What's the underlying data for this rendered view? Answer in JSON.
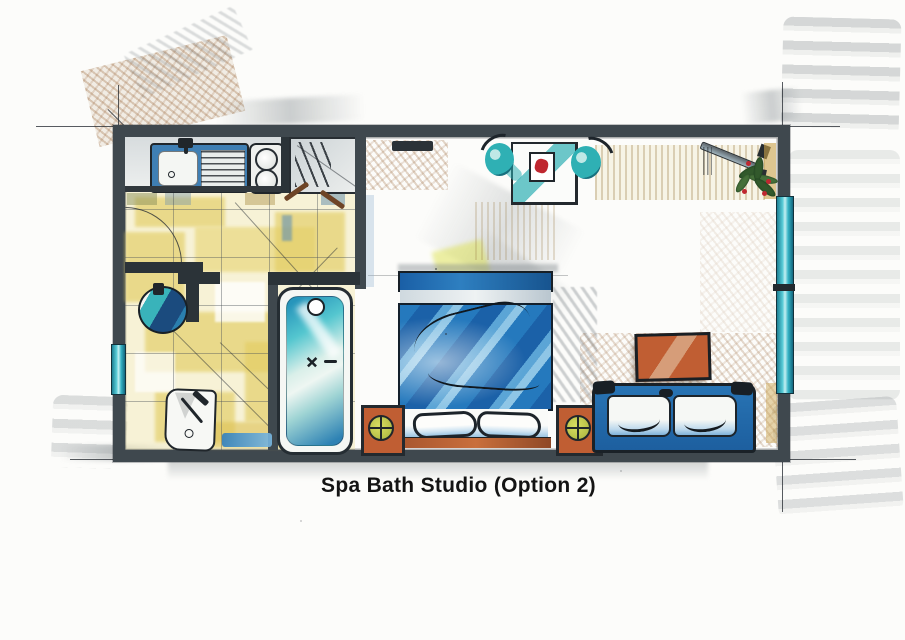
{
  "title": "Spa Bath Studio (Option 2)",
  "colors": {
    "paper": "#fcfcfa",
    "wall": "#3f484e",
    "wall_dark": "#2b3338",
    "ink": "#20262b",
    "tile_patch": "#e3cd63",
    "teal": "#2fb0b4",
    "window_teal": "#49bfcc",
    "bed_blue": "#2579bd",
    "bed_blue_dark": "#1b61a8",
    "bed_blue_light": "#8fc6e6",
    "sofa_blue": "#2874b4",
    "orange": "#c05e33",
    "lamp_green": "#d8de62",
    "hatch_brown": "#a97c50",
    "smudge_gray": "#8d9498",
    "red": "#bf2730",
    "title": "#141414"
  },
  "elements": {
    "kitchen_sink": "kitchen-sink-with-drainboard",
    "stove": "two-burner-hob",
    "wardrobe": "closet-with-hangers",
    "bathroom_sink": "round-washbasin",
    "toilet": "toilet",
    "bathtub": "spa-bathtub",
    "bed": "double-bed",
    "nightstands": "two-nightstands-with-lamps",
    "sofa": "two-seat-sofa",
    "coffee_table": "coffee-table",
    "dining_table": "dining-table-with-two-chairs",
    "plant": "potted-plant",
    "entry_door": "entry-door",
    "windows": "left-and-right-windows"
  }
}
